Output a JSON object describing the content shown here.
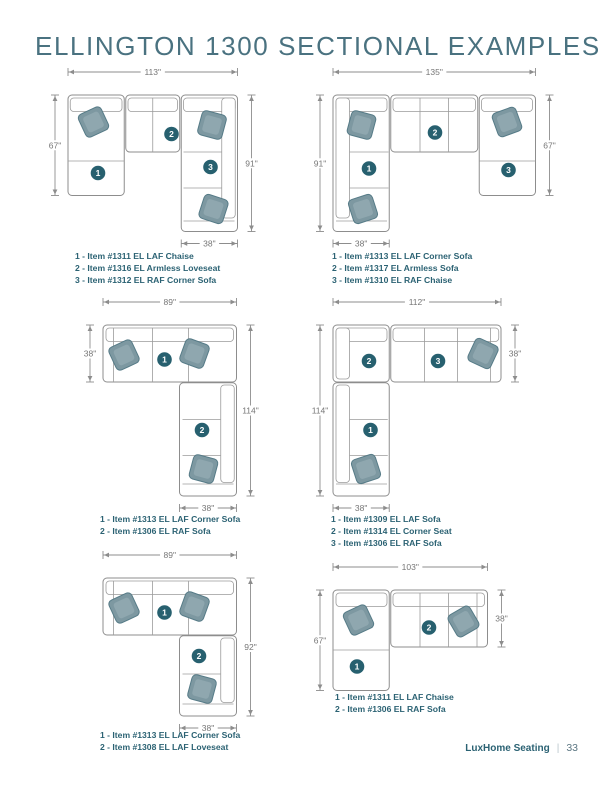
{
  "page": {
    "title": "ELLINGTON 1300 SECTIONAL EXAMPLES",
    "footer": {
      "brand": "LuxHome Seating",
      "separator": "|",
      "page_number": "33"
    }
  },
  "colors": {
    "title": "#4a7280",
    "item_text": "#2b6273",
    "marker": "#27606f",
    "dim_line": "#8d8d8d",
    "dim_text": "#767676",
    "sofa_outline": "#8d8d8d",
    "sofa_seam": "#9b9b9b",
    "pillow_fill": "#7d98a1",
    "pillow_inner": "#8fa7af",
    "pillow_stroke": "#567b87",
    "footer_brand": "#2b6273",
    "footer_page": "#5b7682",
    "separator": "#b9c6cb"
  },
  "diagrams": [
    {
      "items": [
        "1 - Item #1311 EL LAF Chaise",
        "2 - Item #1316 EL Armless Loveseat",
        "3 - Item #1312 EL RAF Corner Sofa"
      ],
      "figure": {
        "w": 113,
        "h": 91,
        "outlines": [
          [
            0,
            0,
            37.5,
            67
          ],
          [
            38.5,
            0,
            36,
            38
          ],
          [
            75.5,
            0,
            37.5,
            91
          ]
        ],
        "backs": [
          [
            1.5,
            2,
            34.5,
            9
          ],
          [
            40,
            2,
            33,
            9
          ],
          [
            77,
            2,
            34.5,
            9
          ],
          [
            102.5,
            2,
            9,
            80
          ]
        ],
        "seams": [
          [
            0,
            44,
            37.5,
            44
          ],
          [
            56.5,
            2,
            56.5,
            38
          ],
          [
            77,
            38,
            102.5,
            38
          ],
          [
            77,
            62,
            102.5,
            62
          ],
          [
            77,
            84,
            111,
            84
          ]
        ],
        "pillows": [
          [
            17,
            18,
            -25
          ],
          [
            96,
            20,
            15
          ],
          [
            97,
            76,
            18
          ]
        ],
        "markers": [
          {
            "n": "1",
            "x": 20,
            "y": 52
          },
          {
            "n": "2",
            "x": 69,
            "y": 26
          },
          {
            "n": "3",
            "x": 95,
            "y": 48
          }
        ],
        "dims": [
          {
            "edge": "top",
            "label": "113\"",
            "s": 0,
            "e": 113
          },
          {
            "edge": "left",
            "label": "67\"",
            "s": 0,
            "e": 67
          },
          {
            "edge": "right",
            "label": "91\"",
            "s": 0,
            "e": 91
          },
          {
            "edge": "bottom",
            "label": "38\"",
            "s": 75.5,
            "e": 113
          }
        ]
      }
    },
    {
      "items": [
        "1 - Item #1313 EL LAF Corner Sofa",
        "2 - Item #1317 EL Armless Sofa",
        "3 - Item #1310 EL RAF Chaise"
      ],
      "figure": {
        "w": 135,
        "h": 91,
        "outlines": [
          [
            0,
            0,
            37.5,
            91
          ],
          [
            38.5,
            0,
            58,
            38
          ],
          [
            97.5,
            0,
            37.5,
            67
          ]
        ],
        "backs": [
          [
            2,
            2,
            34,
            9
          ],
          [
            2,
            2,
            9,
            80
          ],
          [
            40,
            2,
            55,
            9
          ],
          [
            99,
            2,
            34,
            9
          ]
        ],
        "seams": [
          [
            11,
            38,
            37,
            38
          ],
          [
            11,
            62,
            37,
            62
          ],
          [
            2,
            84,
            36,
            84
          ],
          [
            58,
            2,
            58,
            38
          ],
          [
            77,
            2,
            77,
            38
          ],
          [
            97.5,
            44,
            135,
            44
          ]
        ],
        "pillows": [
          [
            19,
            20,
            15
          ],
          [
            116,
            18,
            -20
          ],
          [
            20,
            76,
            -18
          ]
        ],
        "markers": [
          {
            "n": "1",
            "x": 24,
            "y": 49
          },
          {
            "n": "2",
            "x": 68,
            "y": 25
          },
          {
            "n": "3",
            "x": 117,
            "y": 50
          }
        ],
        "dims": [
          {
            "edge": "top",
            "label": "135\"",
            "s": 0,
            "e": 135
          },
          {
            "edge": "left",
            "label": "91\"",
            "s": 0,
            "e": 91
          },
          {
            "edge": "right",
            "label": "67\"",
            "s": 0,
            "e": 67
          },
          {
            "edge": "bottom",
            "label": "38\"",
            "s": 0,
            "e": 37.5
          }
        ]
      }
    },
    {
      "items": [
        "1 - Item #1313 EL LAF Corner Sofa",
        "2 - Item #1306 EL RAF Sofa"
      ],
      "figure": {
        "w": 89,
        "h": 114,
        "outlines": [
          [
            0,
            0,
            89,
            38
          ],
          [
            51,
            38.5,
            38,
            75.5
          ]
        ],
        "backs": [
          [
            2,
            2,
            85,
            9
          ],
          [
            78.5,
            40,
            9,
            65
          ]
        ],
        "seams": [
          [
            7,
            2,
            7,
            38
          ],
          [
            33,
            2,
            33,
            38
          ],
          [
            57,
            2,
            57,
            38
          ],
          [
            53,
            63,
            78.5,
            63
          ],
          [
            53,
            87,
            78.5,
            87
          ],
          [
            53,
            106,
            87,
            106
          ]
        ],
        "pillows": [
          [
            14,
            20,
            -25
          ],
          [
            61,
            19,
            20
          ],
          [
            67,
            96,
            15
          ]
        ],
        "markers": [
          {
            "n": "1",
            "x": 41,
            "y": 23
          },
          {
            "n": "2",
            "x": 66,
            "y": 70
          }
        ],
        "dims": [
          {
            "edge": "top",
            "label": "89\"",
            "s": 0,
            "e": 89
          },
          {
            "edge": "left",
            "label": "38\"",
            "s": 0,
            "e": 38
          },
          {
            "edge": "right",
            "label": "114\"",
            "s": 0,
            "e": 114
          },
          {
            "edge": "bottom",
            "label": "38\"",
            "s": 51,
            "e": 89
          }
        ]
      }
    },
    {
      "items": [
        "1 - Item #1309 EL LAF Sofa",
        "2 - Item #1314 EL Corner Seat",
        "3 - Item #1306 EL RAF Sofa"
      ],
      "figure": {
        "w": 112,
        "h": 114,
        "outlines": [
          [
            0,
            0,
            37.5,
            38
          ],
          [
            38.5,
            0,
            73.5,
            38
          ],
          [
            0,
            38.5,
            37.5,
            75.5
          ]
        ],
        "backs": [
          [
            2,
            2,
            34,
            9
          ],
          [
            2,
            2,
            9,
            34
          ],
          [
            40,
            2,
            70.5,
            9
          ],
          [
            2,
            40,
            9,
            65
          ]
        ],
        "seams": [
          [
            61,
            2,
            61,
            38
          ],
          [
            83,
            2,
            83,
            38
          ],
          [
            105,
            2,
            105,
            38
          ],
          [
            11,
            63,
            36.5,
            63
          ],
          [
            11,
            87,
            36.5,
            87
          ],
          [
            2,
            106,
            36,
            106
          ]
        ],
        "pillows": [
          [
            100,
            19,
            25
          ],
          [
            22,
            96,
            -18
          ]
        ],
        "markers": [
          {
            "n": "1",
            "x": 25,
            "y": 70
          },
          {
            "n": "2",
            "x": 24,
            "y": 24
          },
          {
            "n": "3",
            "x": 70,
            "y": 24
          }
        ],
        "dims": [
          {
            "edge": "top",
            "label": "112\"",
            "s": 0,
            "e": 112
          },
          {
            "edge": "left",
            "label": "114\"",
            "s": 0,
            "e": 114
          },
          {
            "edge": "right",
            "label": "38\"",
            "s": 0,
            "e": 38
          },
          {
            "edge": "bottom",
            "label": "38\"",
            "s": 0,
            "e": 37.5
          }
        ]
      }
    },
    {
      "items": [
        "1 - Item #1313 EL LAF Corner Sofa",
        "2 - Item #1308 EL LAF Loveseat"
      ],
      "figure": {
        "w": 89,
        "h": 92,
        "outlines": [
          [
            0,
            0,
            89,
            38
          ],
          [
            51,
            38.5,
            38,
            53.5
          ]
        ],
        "backs": [
          [
            2,
            2,
            85,
            9
          ],
          [
            78.5,
            40,
            9,
            43
          ]
        ],
        "seams": [
          [
            7,
            2,
            7,
            38
          ],
          [
            33,
            2,
            33,
            38
          ],
          [
            57,
            2,
            57,
            38
          ],
          [
            53,
            64,
            78.5,
            64
          ],
          [
            53,
            84,
            87,
            84
          ]
        ],
        "pillows": [
          [
            14,
            20,
            -25
          ],
          [
            61,
            19,
            20
          ],
          [
            66,
            74,
            15
          ]
        ],
        "markers": [
          {
            "n": "1",
            "x": 41,
            "y": 23
          },
          {
            "n": "2",
            "x": 64,
            "y": 52
          }
        ],
        "dims": [
          {
            "edge": "top",
            "label": "89\"",
            "s": 0,
            "e": 89
          },
          {
            "edge": "right",
            "label": "92\"",
            "s": 0,
            "e": 92
          },
          {
            "edge": "bottom",
            "label": "38\"",
            "s": 51,
            "e": 89
          }
        ]
      }
    },
    {
      "items": [
        "1 - Item #1311 EL LAF Chaise",
        "2 - Item #1306 EL RAF Sofa"
      ],
      "figure": {
        "w": 103,
        "h": 67,
        "outlines": [
          [
            0,
            0,
            37.5,
            67
          ],
          [
            38.5,
            0,
            64.5,
            38
          ]
        ],
        "backs": [
          [
            2,
            2,
            34,
            9
          ],
          [
            40,
            2,
            61,
            9
          ]
        ],
        "seams": [
          [
            0,
            40,
            37.5,
            40
          ],
          [
            58,
            2,
            58,
            38
          ],
          [
            77,
            2,
            77,
            38
          ],
          [
            96,
            2,
            96,
            38
          ]
        ],
        "pillows": [
          [
            17,
            20,
            -25
          ],
          [
            87,
            21,
            -30
          ]
        ],
        "markers": [
          {
            "n": "1",
            "x": 16,
            "y": 51
          },
          {
            "n": "2",
            "x": 64,
            "y": 25
          }
        ],
        "dims": [
          {
            "edge": "top",
            "label": "103\"",
            "s": 0,
            "e": 103
          },
          {
            "edge": "left",
            "label": "67\"",
            "s": 0,
            "e": 67
          },
          {
            "edge": "right",
            "label": "38\"",
            "s": 0,
            "e": 38
          }
        ]
      }
    }
  ]
}
